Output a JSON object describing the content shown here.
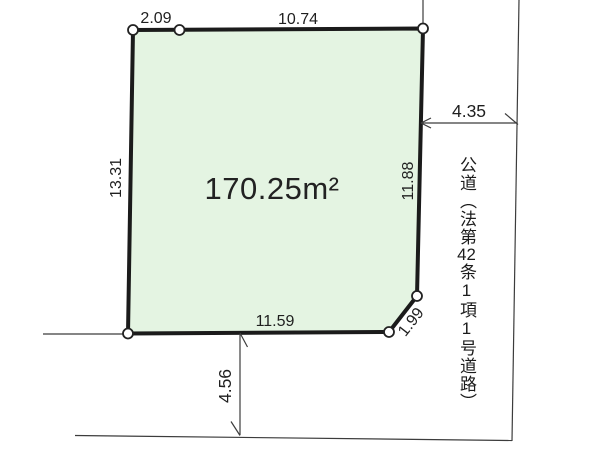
{
  "diagram": {
    "area_label": "170.25m²",
    "dimensions": {
      "top_offset": "2.09",
      "top": "10.74",
      "left": "13.31",
      "right": "11.88",
      "road_width": "4.35",
      "bottom": "11.59",
      "corner_cut": "1.99",
      "road_offset": "4.56"
    },
    "road_label_parts": {
      "p1": "公道（法第",
      "p2": "42",
      "p3": "条1項1号道路）"
    },
    "colors": {
      "parcel_fill": "#e4f4e2",
      "parcel_stroke": "#1b1b1b",
      "thin_line": "#3c3c3c",
      "text": "#1f1f1f"
    }
  }
}
